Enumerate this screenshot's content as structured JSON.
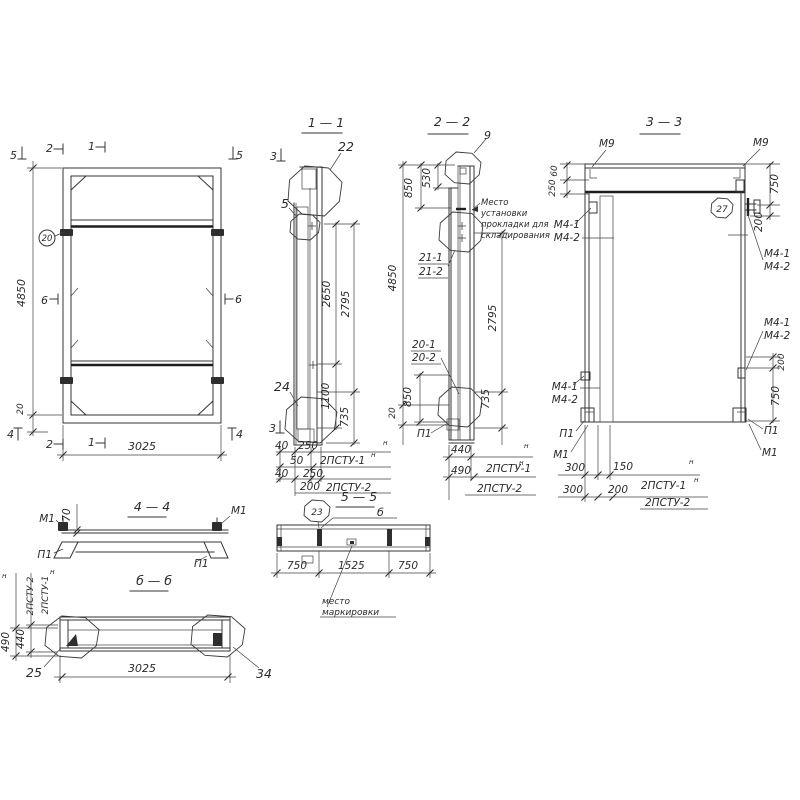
{
  "views": {
    "front": {
      "marks": {
        "m5l": "5",
        "m2t": "2",
        "m1t": "1",
        "m5r": "5",
        "m6l": "6",
        "m6r": "6",
        "m4l": "4",
        "m2b": "2",
        "m1b": "1",
        "m4r": "4"
      },
      "callout20": "20",
      "dims": {
        "h": "4850",
        "off": "20",
        "w": "3025"
      }
    },
    "s11": {
      "title": "1 — 1",
      "mark3": "3",
      "c22": "22",
      "c5": "5",
      "c24": "24",
      "dims": {
        "d2650": "2650",
        "d2795": "2795",
        "d1100": "1100",
        "d735": "735",
        "r1a": "40",
        "r1b": "250",
        "r2": "50",
        "r3a": "40",
        "r3b": "250",
        "r4": "200"
      },
      "lbl1": "2ПСТУ-1",
      "lbl2": "2ПСТУ-2",
      "sup": "н"
    },
    "s22": {
      "title": "2 — 2",
      "c9": "9",
      "note": [
        "Место",
        "установки",
        "прокладки для",
        "складирования"
      ],
      "p211": "21-1",
      "p212": "21-2",
      "p201": "20-1",
      "p202": "20-2",
      "pp1": "П1",
      "dims": {
        "d850t": "850",
        "d530": "530",
        "d4850": "4850",
        "d20": "20",
        "d2795": "2795",
        "d735": "735",
        "d850b": "850",
        "r1": "440",
        "r2": "490"
      },
      "lbl1": "2ПСТУ-1",
      "lbl2": "2ПСТУ-2",
      "sup": "н"
    },
    "s33": {
      "title": "3 — 3",
      "m9": "М9",
      "c27": "27",
      "m41": "М4-1",
      "m42": "М4-2",
      "p1": "П1",
      "m1": "М1",
      "dims": {
        "d60": "60",
        "d250": "250",
        "d750t": "750",
        "d200t": "200",
        "d200b": "200",
        "d750b": "750",
        "r1a": "300",
        "r1b": "150",
        "r2a": "300",
        "r2b": "200"
      },
      "lbl1": "2ПСТУ-1",
      "lbl2": "2ПСТУ-2",
      "sup": "н"
    },
    "s44": {
      "title": "4 — 4",
      "m1": "М1",
      "p1": "П1",
      "d70": "70"
    },
    "s55": {
      "title": "5 — 5",
      "c23": "23",
      "cb": "б",
      "note": [
        "место",
        "маркировки"
      ],
      "dims": {
        "left": "750",
        "mid": "1525",
        "right": "750"
      }
    },
    "sbb": {
      "title": "б — б",
      "c25": "25",
      "c34": "34",
      "dims": {
        "w": "3025",
        "d490": "490",
        "d440": "440"
      },
      "lbl1": "2ПСТУ-1",
      "lbl2": "2ПСТУ-2",
      "sup": "н"
    }
  }
}
